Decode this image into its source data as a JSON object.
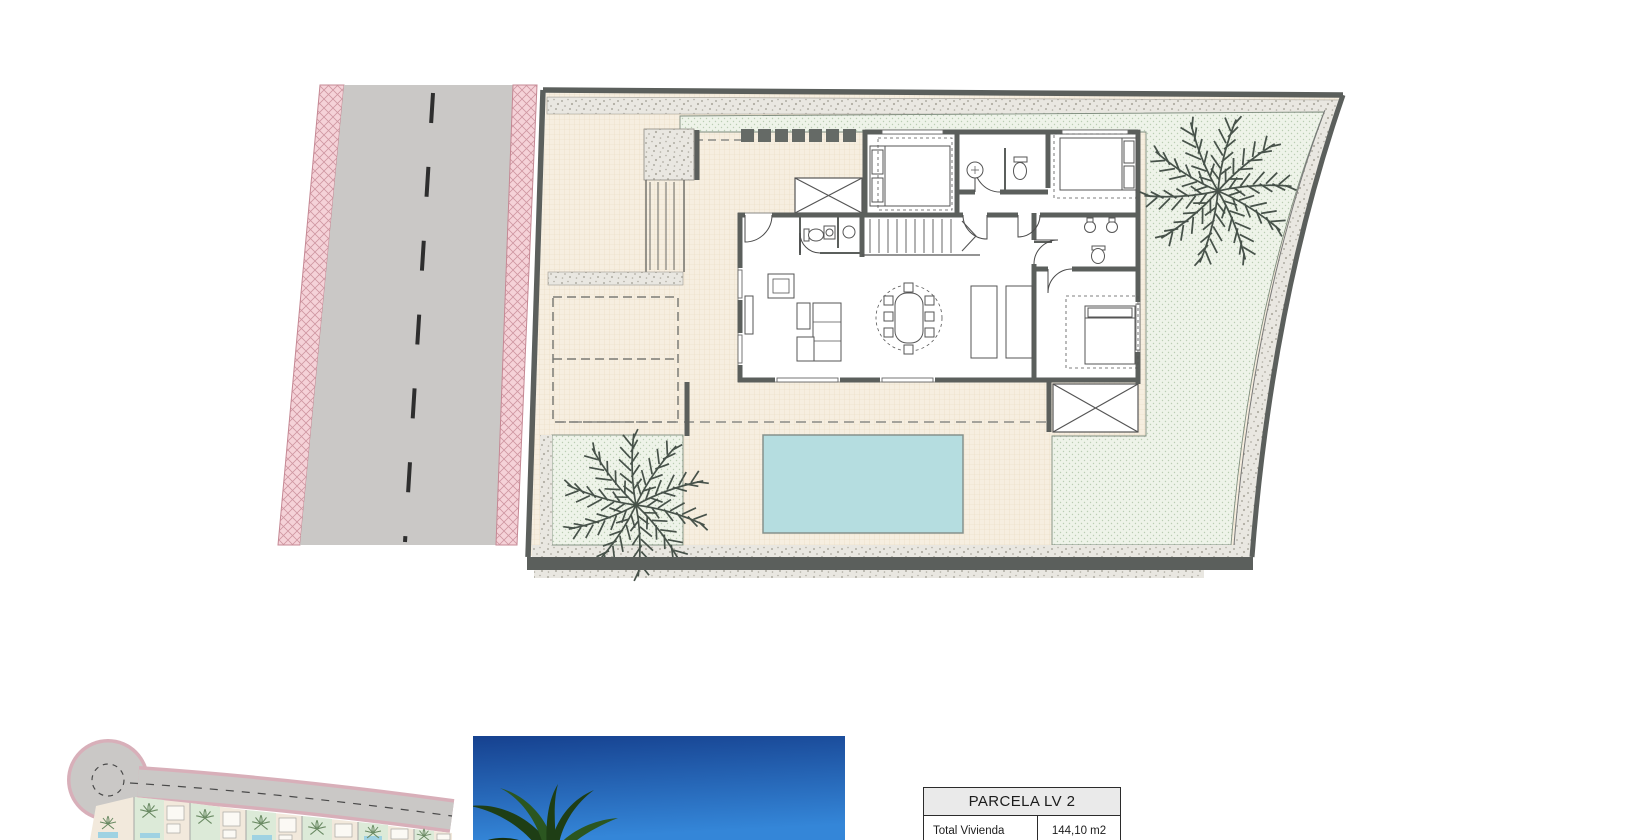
{
  "parcel_table": {
    "header": "PARCELA LV 2",
    "rows": [
      {
        "label": "Total Vivienda",
        "value": "144,10 m2"
      }
    ]
  },
  "colors": {
    "road_gray": "#cac8c6",
    "road_dash": "#2e2e2e",
    "verge_pink": "#f5d2d8",
    "verge_hatch": "#cf97a2",
    "plot_wall": "#5b5f5c",
    "terrace_cream": "#f6eee0",
    "garden_green": "#eef3e9",
    "pool_blue": "#b5dde0",
    "gravel_stipple": "#e9e7e1",
    "palm_plan": "#47524a",
    "sky_top": "#16418f",
    "sky_bottom": "#3486d8",
    "photo_palm": "#1e3e15",
    "table_header_bg": "#eaeaea",
    "table_border": "#2b2b2b"
  },
  "icons": {
    "palm-tree-icon": "radial frond star glyph",
    "stairs-icon": "parallel tread lines",
    "storage-x-icon": "rectangle with diagonal cross",
    "cul-de-sac-icon": "road turning circle"
  }
}
